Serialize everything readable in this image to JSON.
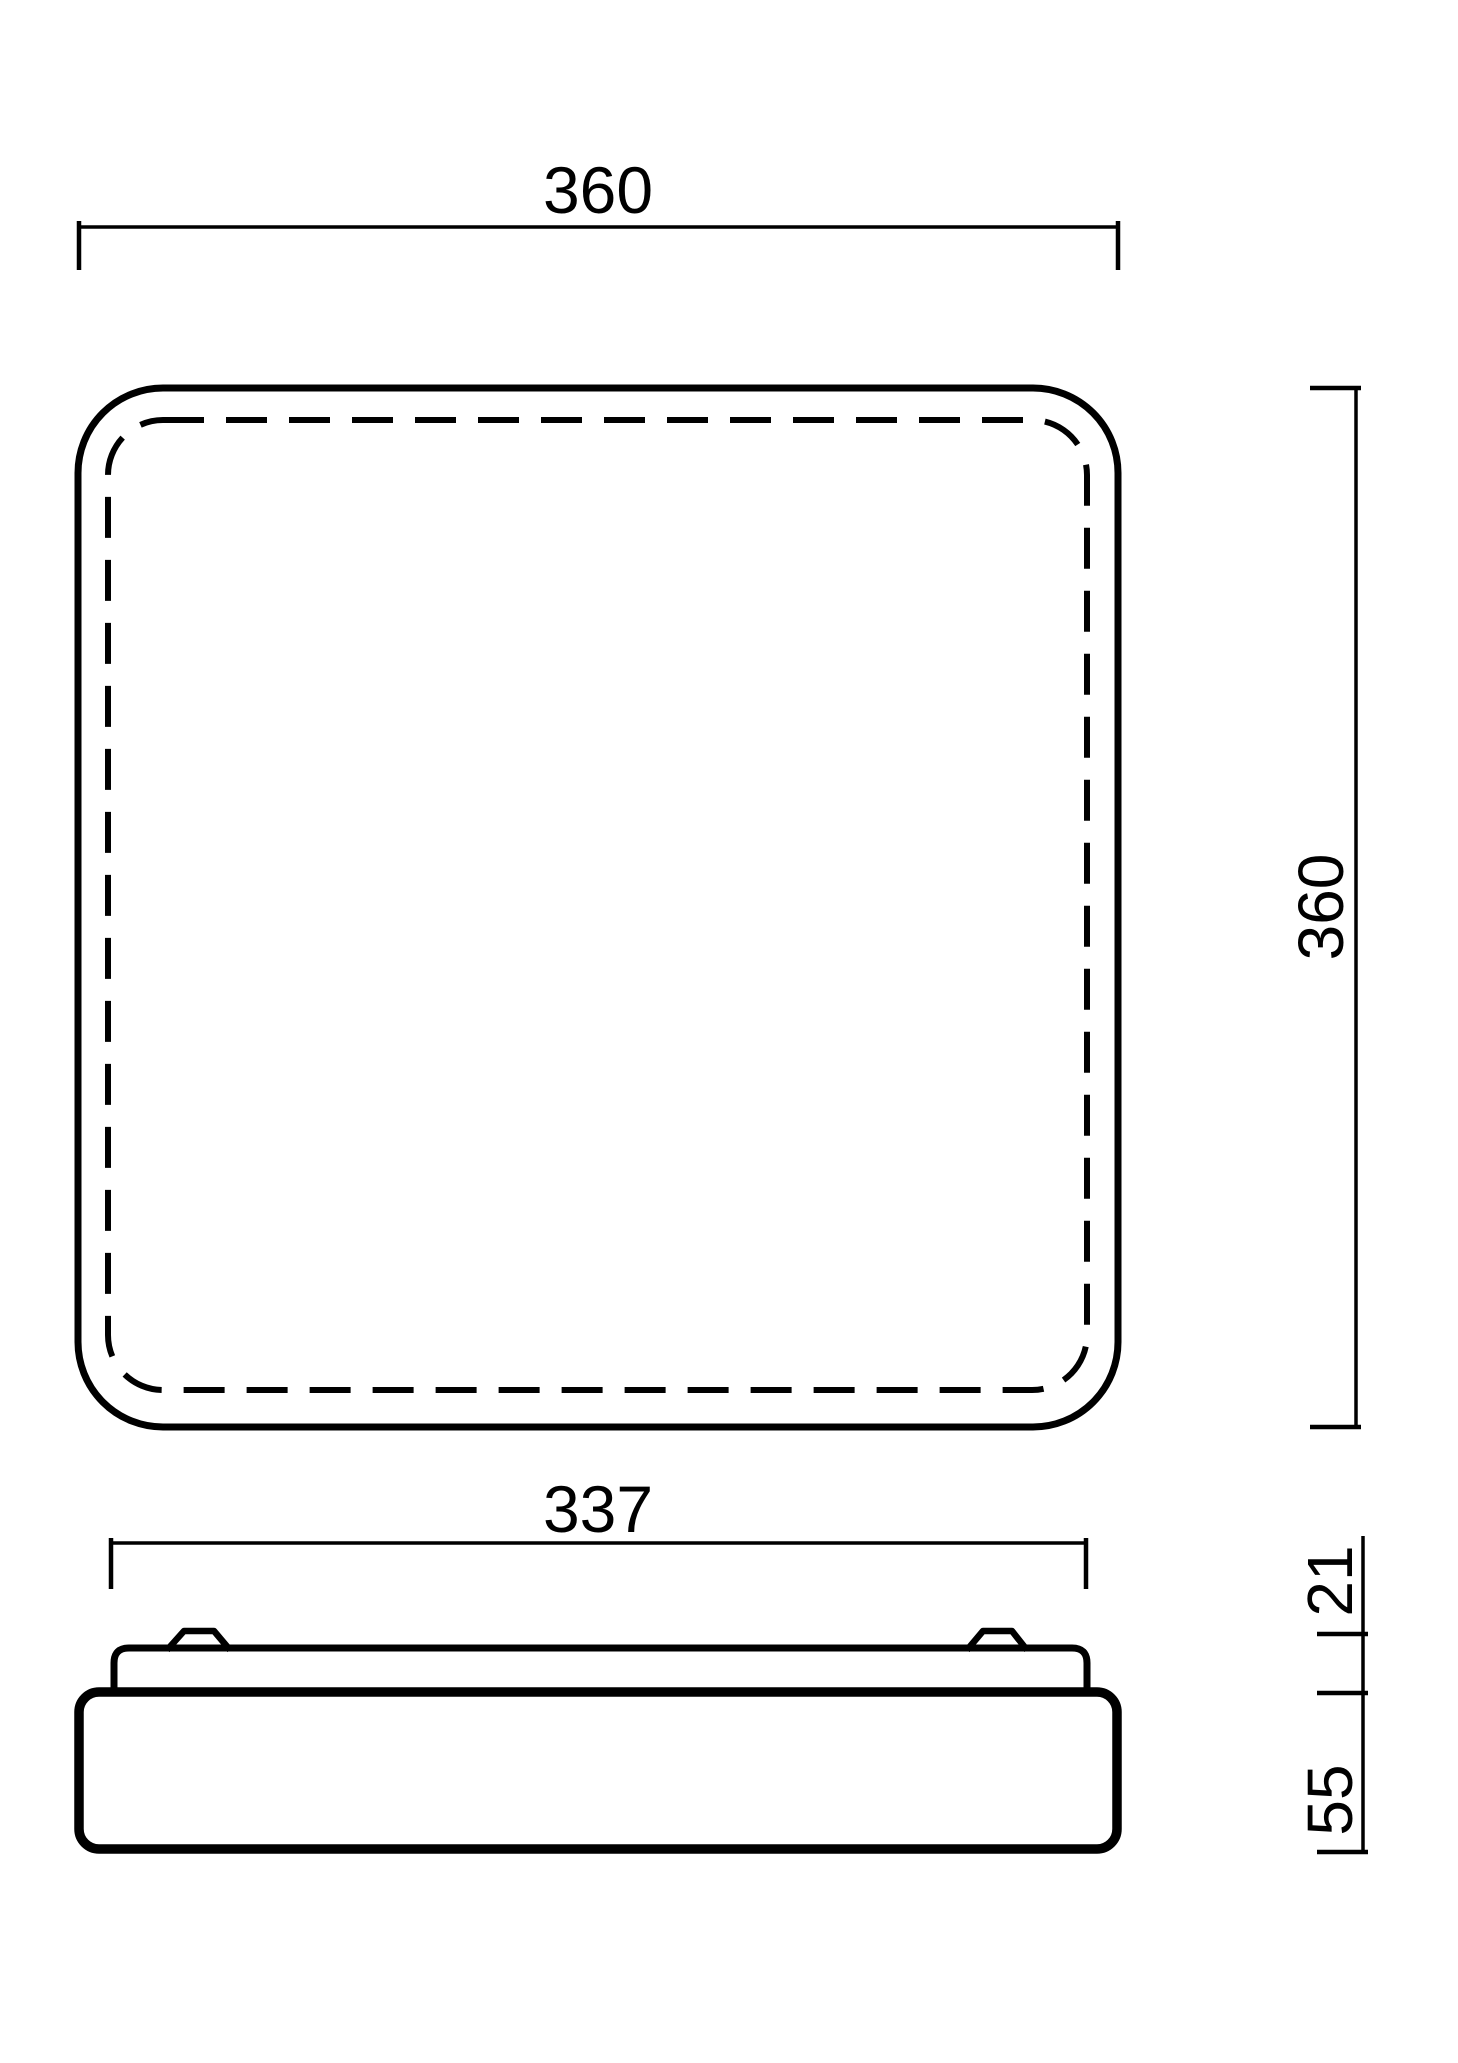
{
  "colors": {
    "line": "#000000",
    "background": "#ffffff"
  },
  "dimensions": {
    "top_view_width": "360",
    "top_view_height": "360",
    "side_view_width": "337",
    "side_view_upper_height": "21",
    "side_view_lower_height": "55"
  }
}
